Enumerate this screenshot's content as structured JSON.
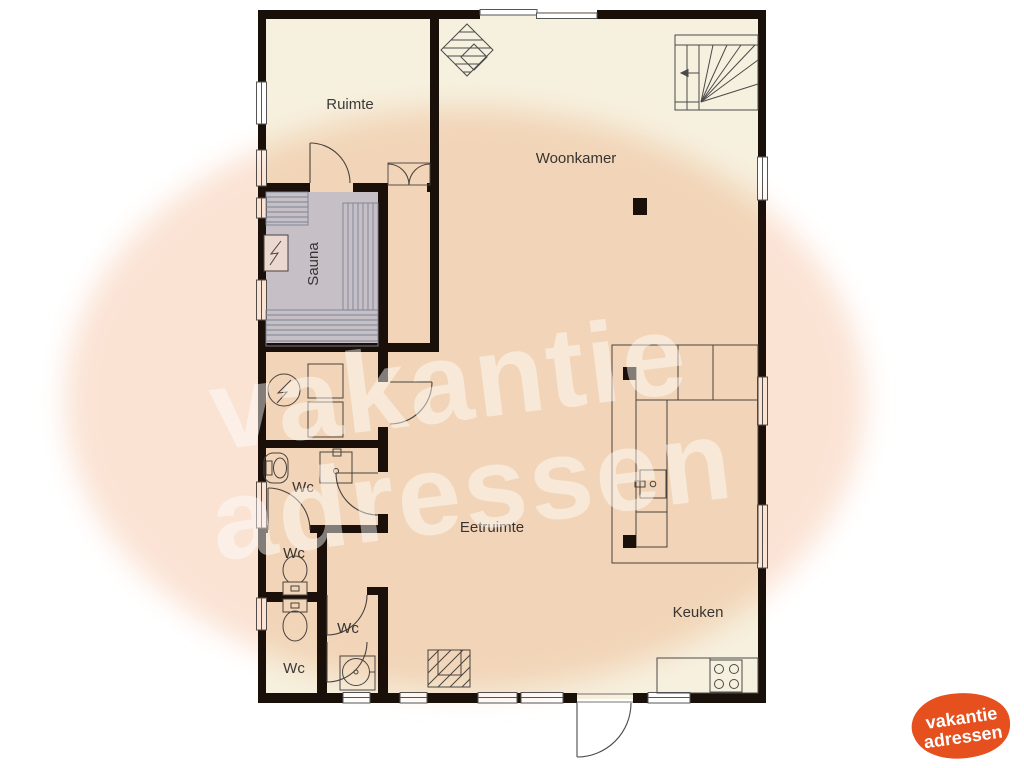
{
  "rooms": {
    "ruimte": "Ruimte",
    "woonkamer": "Woonkamer",
    "sauna": "Sauna",
    "eetruimte": "Eetruimte",
    "keuken": "Keuken"
  },
  "wc_labels": {
    "washroom": "Wc",
    "wc_upper": "Wc",
    "wc_lower": "Wc",
    "wc_middle": "Wc"
  },
  "branding": {
    "watermark_line1": "vakantie",
    "watermark_line2": "adressen",
    "logo_line1": "vakantie",
    "logo_line2": "adressen"
  },
  "colors": {
    "wall": "#1A100A",
    "floor": "#F6F0DE",
    "sauna_floor": "#C9D7ED",
    "sauna_line": "#7E93B5",
    "fixture_line": "#4A4A4A",
    "label": "#3A3A3A",
    "overlay": "#FBE3D4",
    "logo_orange": "#E5501E"
  }
}
